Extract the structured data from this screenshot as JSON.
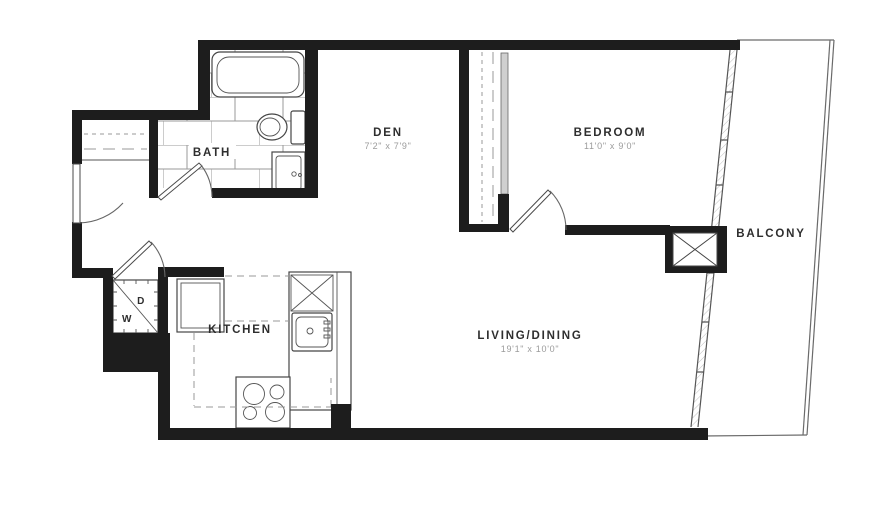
{
  "floorplan": {
    "rooms": {
      "bath": {
        "name": "BATH"
      },
      "den": {
        "name": "DEN",
        "dims": "7'2\" x 7'9\""
      },
      "bedroom": {
        "name": "BEDROOM",
        "dims": "11'0\" x 9'0\""
      },
      "kitchen": {
        "name": "KITCHEN"
      },
      "living_dining": {
        "name": "LIVING/DINING",
        "dims": "19'1\" x 10'0\""
      },
      "balcony": {
        "name": "BALCONY"
      }
    },
    "appliances": {
      "washer": "W",
      "dryer": "D"
    },
    "colors": {
      "wall": "#1d1d1d",
      "fixture_line": "#454545",
      "dash_line": "#9a9a9a",
      "label_text": "#2e2e2e",
      "dims_text": "#9b9b9b"
    }
  }
}
